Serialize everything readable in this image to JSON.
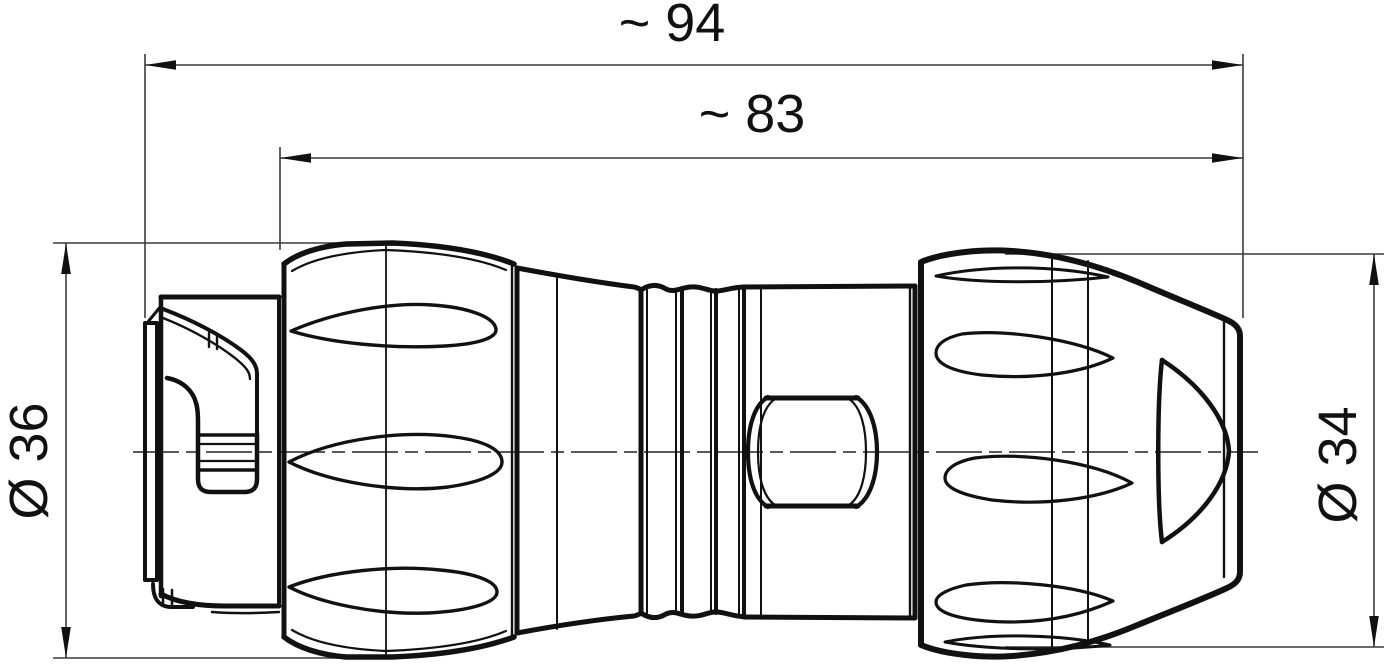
{
  "drawing": {
    "type": "technical-dimension-drawing",
    "subject": "circular-connector-side-view",
    "background": "#ffffff",
    "line_color": "#111111",
    "dimension_line_color": "#3a3a3a",
    "dimensions": {
      "overall_length": "~ 94",
      "body_length": "~ 83",
      "left_diameter": "Ø 36",
      "right_diameter": "Ø 34"
    }
  }
}
